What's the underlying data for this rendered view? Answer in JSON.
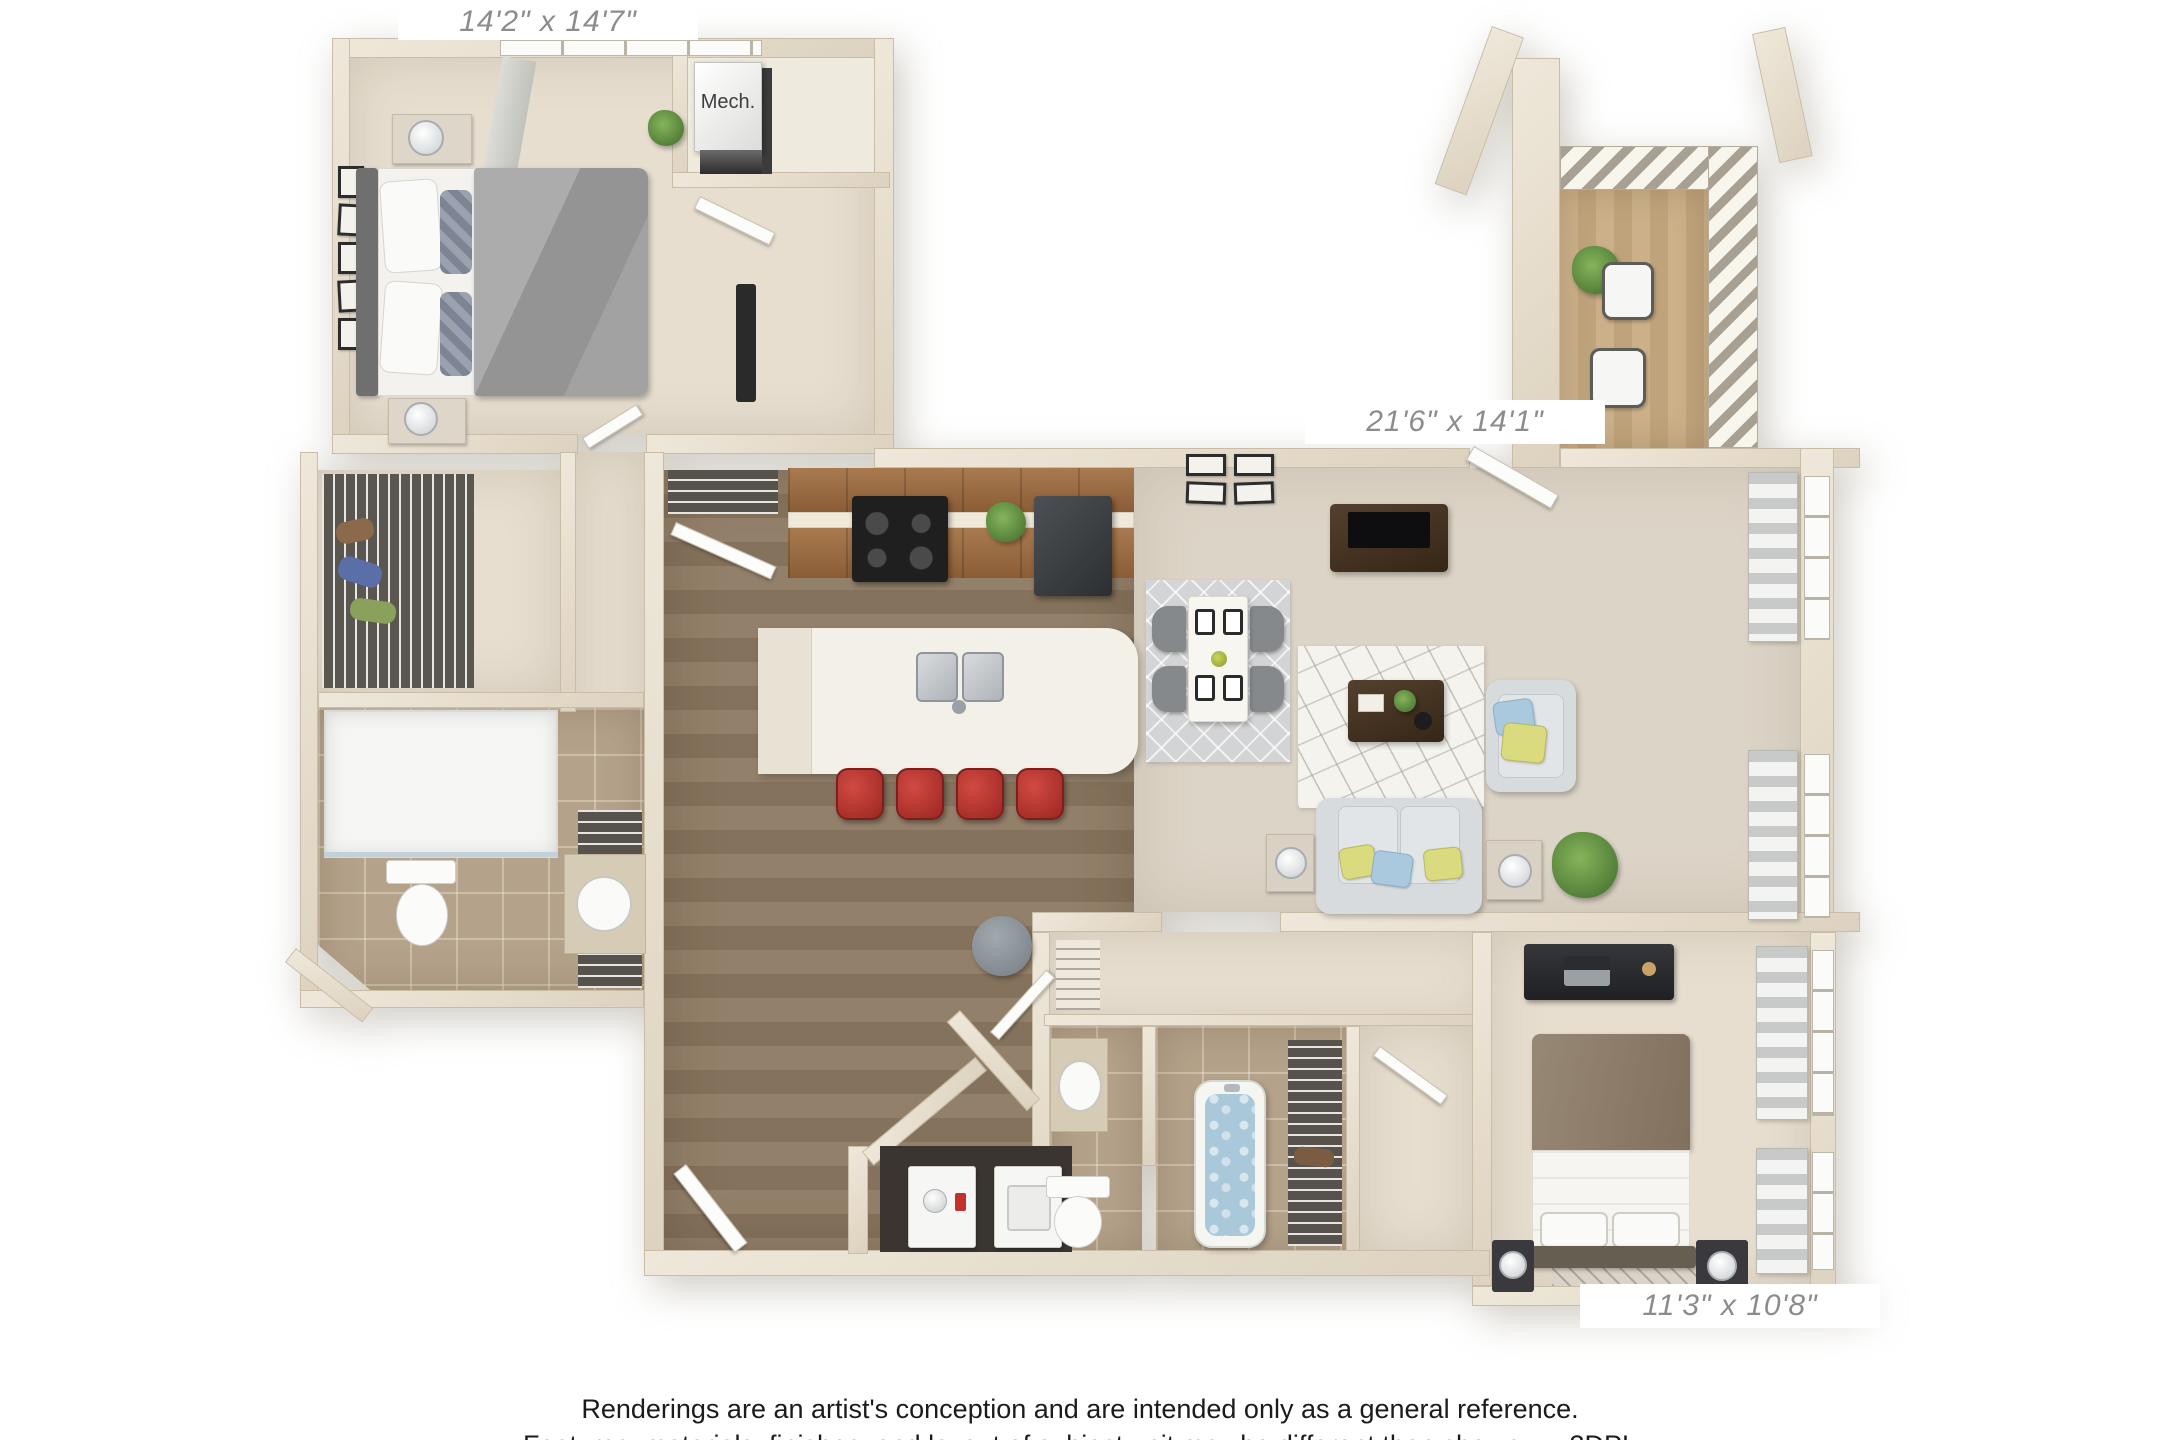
{
  "floor_plan": {
    "bedroom1": {
      "dimensions": "14'2\" x 14'7\""
    },
    "living_dining": {
      "dimensions": "21'6\" x 14'1\""
    },
    "bedroom2": {
      "dimensions": "11'3\" x 10'8\""
    },
    "mech_closet": {
      "label": "Mech."
    },
    "rooms_depicted": [
      "bedroom-1",
      "walk-in-closet",
      "bathroom-1",
      "hallway",
      "kitchen",
      "entry",
      "living-dining",
      "balcony",
      "bathroom-2",
      "laundry",
      "bedroom-2",
      "mech-closet"
    ]
  },
  "footer": {
    "line1": "Renderings are an artist's conception and are intended only as a general reference.",
    "line2": "Features, materials, finishes, and layout of subject unit may be different than shown.",
    "watermark": "3DPL"
  },
  "palette": {
    "wall": "#e5dccb",
    "carpet": "#e7decf",
    "living_carpet": "#dcd4c6",
    "wood_floor": "#8c7861",
    "bath_tile": "#b5a28a",
    "balcony_deck": "#c6ab83",
    "cabinet_brown": "#9a6a42",
    "stool_red": "#b23430",
    "sofa_gray": "#d7dbdd",
    "pillow_yellow": "#dadb7f",
    "pillow_blue": "#aac9df",
    "console_brown": "#4a372a",
    "tub_water": "#a9c8da",
    "plant_green": "#5f8f46",
    "label_gray": "#8c8c8c",
    "text_black": "#1b1b1b"
  }
}
